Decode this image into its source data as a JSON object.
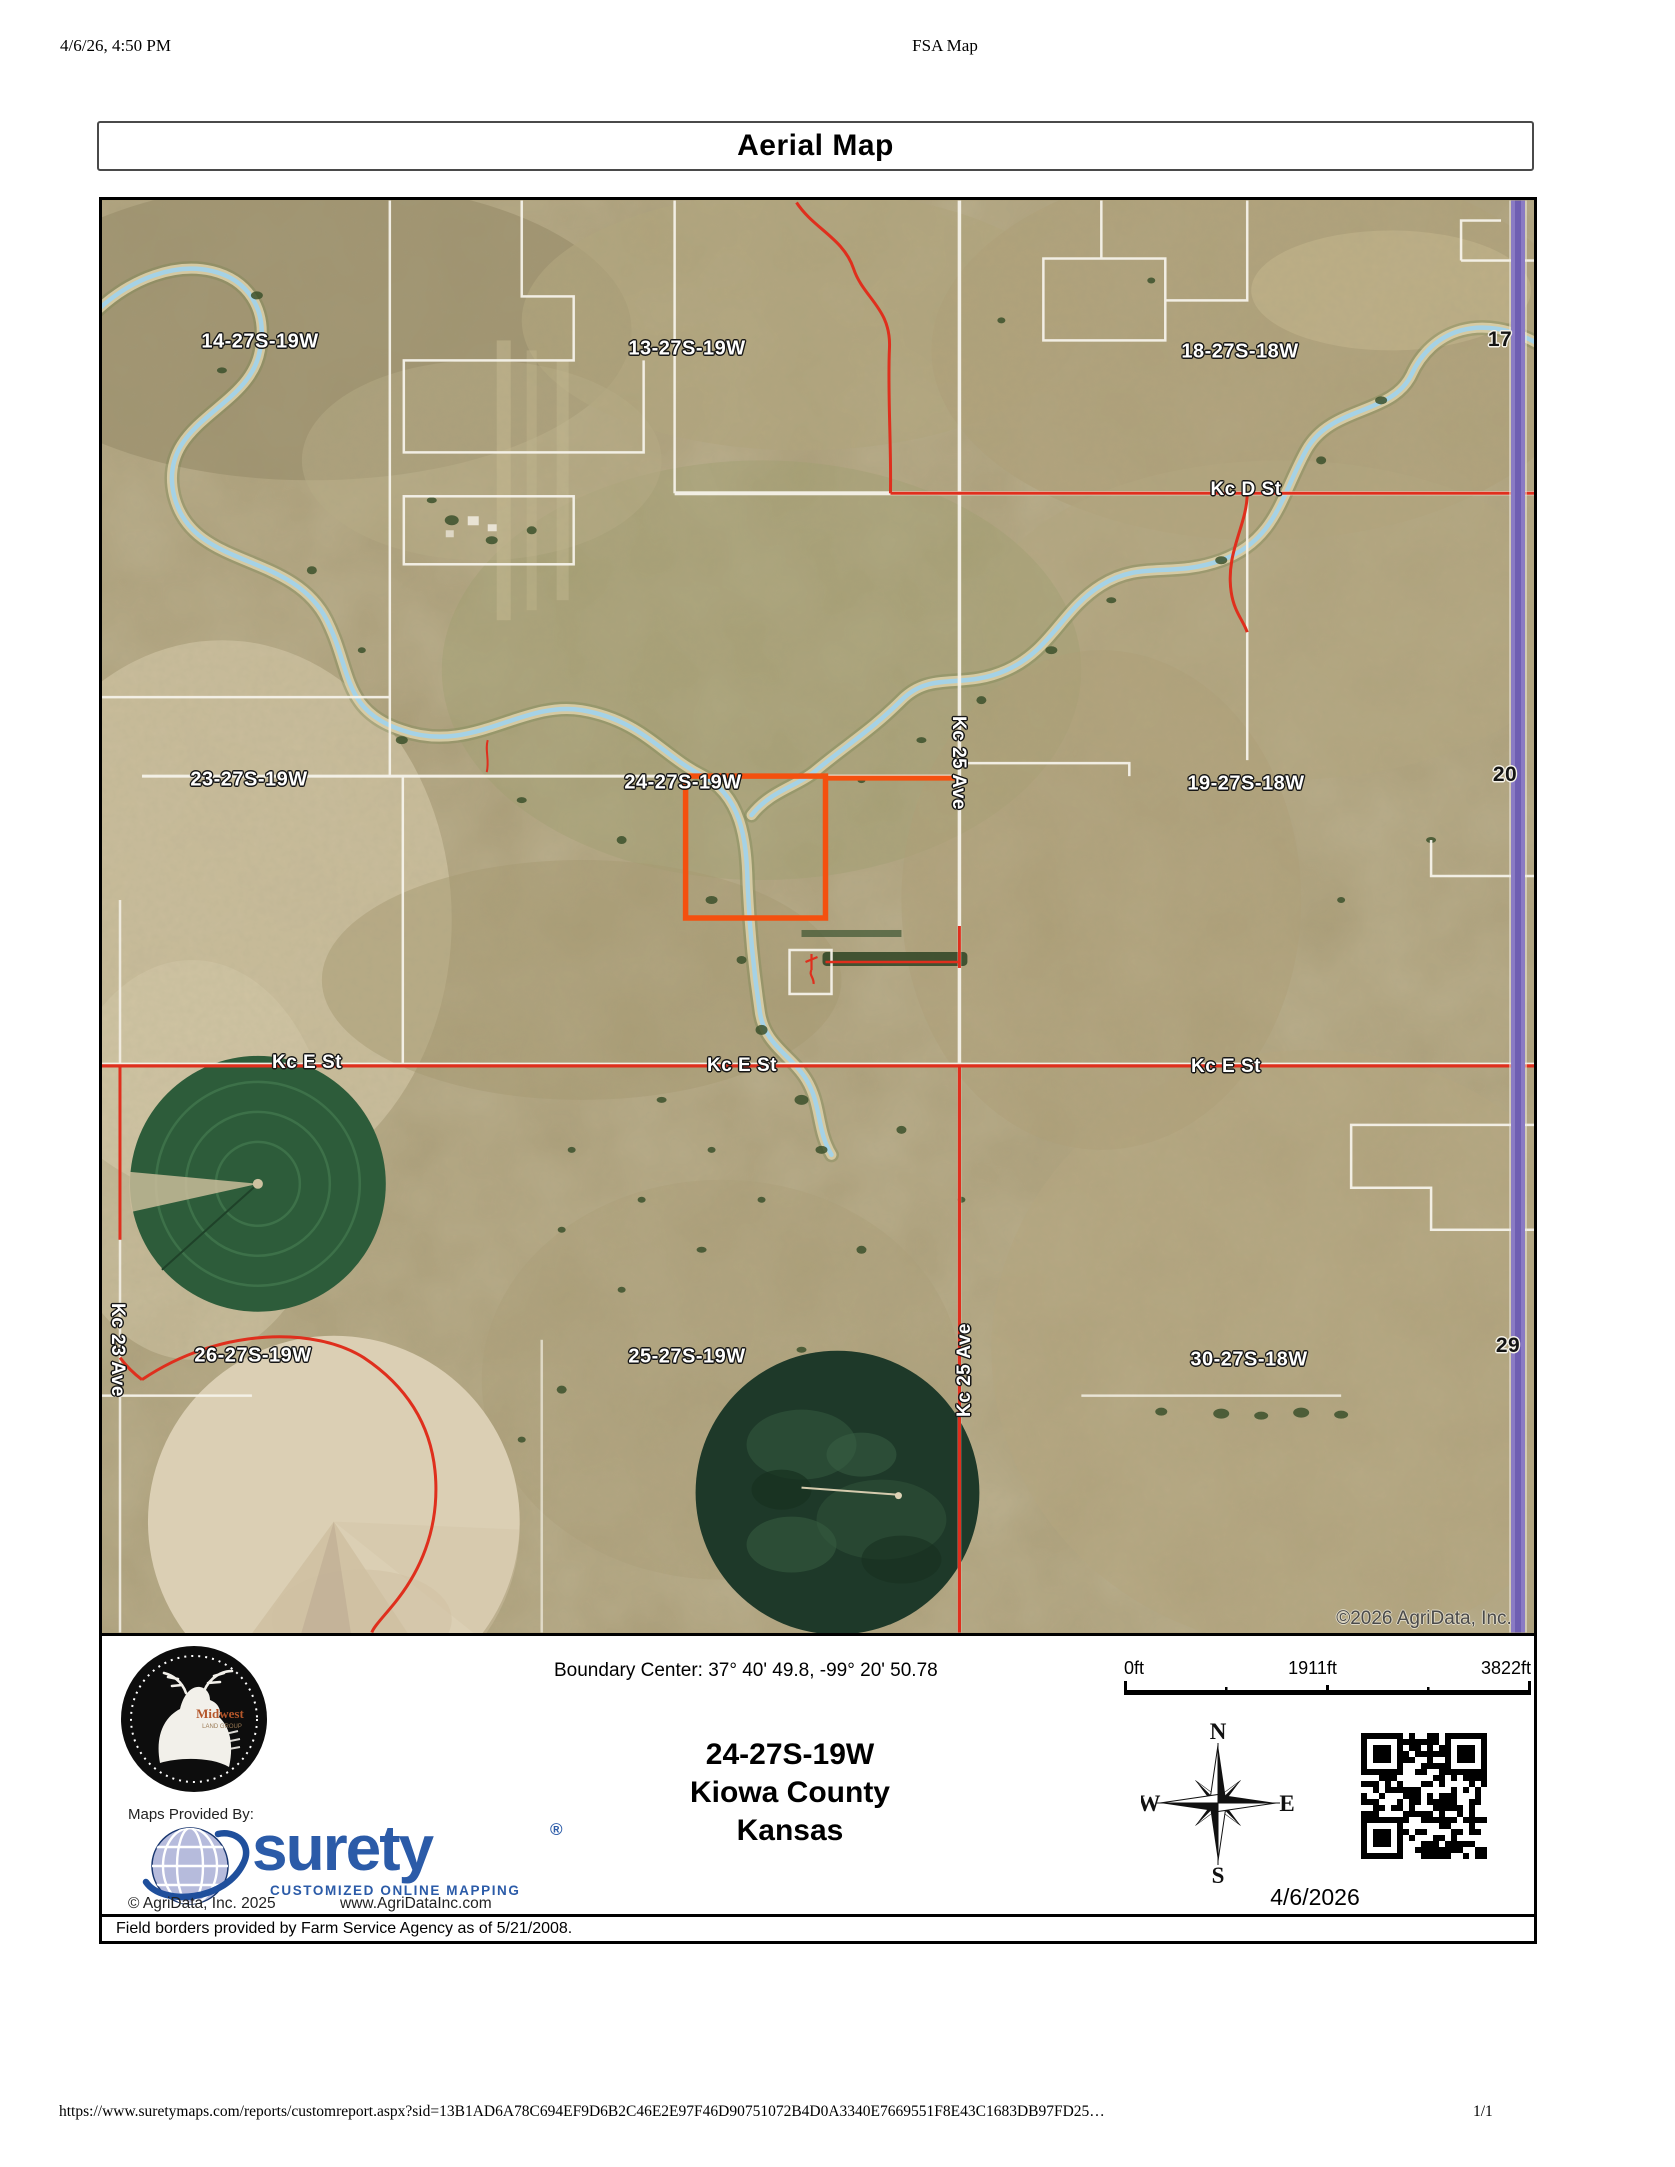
{
  "browser": {
    "timestamp": "4/6/26, 4:50 PM",
    "doc_title": "FSA Map",
    "url": "https://www.suretymaps.com/reports/customreport.aspx?sid=13B1AD6A78C694EF9D6B2C46E2E97F46D90751072B4D0A3340E7669551F8E43C1683DB97FD25…",
    "page_number": "1/1"
  },
  "report_title": "Aerial Map",
  "map": {
    "labels": [
      {
        "t": "14-27S-19W",
        "x": 158,
        "y": 142
      },
      {
        "t": "13-27S-19W",
        "x": 585,
        "y": 149
      },
      {
        "t": "18-27S-18W",
        "x": 1138,
        "y": 152
      },
      {
        "t": "17",
        "x": 1398,
        "y": 140
      },
      {
        "t": "Kc D St",
        "x": 1144,
        "y": 290
      },
      {
        "t": "23-27S-19W",
        "x": 147,
        "y": 580
      },
      {
        "t": "24-27S-19W",
        "x": 581,
        "y": 583
      },
      {
        "t": "19-27S-18W",
        "x": 1144,
        "y": 584
      },
      {
        "t": "20",
        "x": 1403,
        "y": 575
      },
      {
        "t": "Kc 25 Ave",
        "x": 856,
        "y": 563
      },
      {
        "t": "Kc E St",
        "x": 205,
        "y": 863
      },
      {
        "t": "Kc E St",
        "x": 640,
        "y": 866
      },
      {
        "t": "Kc E St",
        "x": 1124,
        "y": 867
      },
      {
        "t": "26-27S-19W",
        "x": 151,
        "y": 1156
      },
      {
        "t": "25-27S-19W",
        "x": 585,
        "y": 1157
      },
      {
        "t": "30-27S-18W",
        "x": 1147,
        "y": 1160
      },
      {
        "t": "29",
        "x": 1406,
        "y": 1146
      },
      {
        "t": "Kc 23 Ave",
        "x": 15,
        "y": 1150
      },
      {
        "t": "Kc 25 Ave",
        "x": 863,
        "y": 1170
      },
      {
        "t": "©2026 AgriData, Inc.",
        "x": 1322,
        "y": 1419
      }
    ],
    "colors": {
      "parcel_highlight": "#f4500f",
      "road_red": "#df2f1d",
      "road_purple": "#8a7bc4",
      "river_blue": "#a5d2e6",
      "terrain_tan": "#ab9d78"
    }
  },
  "info": {
    "boundary_center": "Boundary Center: 37° 40' 49.8, -99° 20' 50.78",
    "scalebar": {
      "start": "0ft",
      "mid": "1911ft",
      "end": "3822ft"
    },
    "location": {
      "plss": "24-27S-19W",
      "county": "Kiowa County",
      "state": "Kansas"
    },
    "compass": {
      "n": "N",
      "e": "E",
      "s": "S",
      "w": "W"
    },
    "report_date": "4/6/2026",
    "branding": {
      "midwest_name": "Midwest",
      "midwest_sub": "LAND GROUP",
      "maps_provided_by": "Maps Provided By:",
      "surety": "surety",
      "registered": "®",
      "tagline": "CUSTOMIZED ONLINE MAPPING",
      "copyright": "© AgriData, Inc. 2025",
      "website": "www.AgriDataInc.com",
      "surety_blue": "#2b5ba8"
    },
    "field_note": "Field borders provided by Farm Service Agency as of 5/21/2008."
  }
}
